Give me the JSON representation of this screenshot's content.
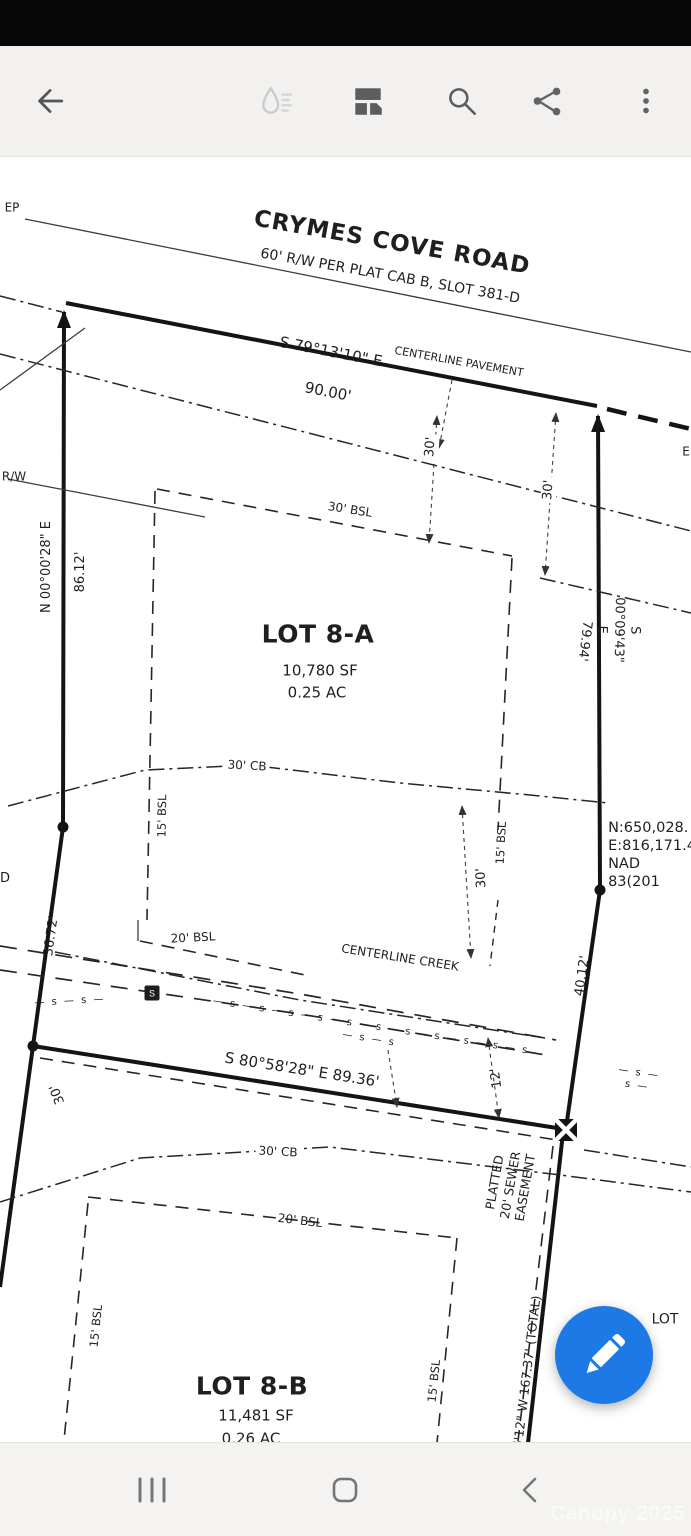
{
  "toolbar": {
    "icons": [
      "back-arrow",
      "ink-drop (disabled)",
      "collage",
      "search",
      "share",
      "overflow-menu"
    ]
  },
  "plat": {
    "labels": [
      {
        "id": "ep-label",
        "t": "EP",
        "x": 12,
        "y": 208,
        "r": 0,
        "s": 12
      },
      {
        "id": "rw-label",
        "t": "R/W",
        "x": 14,
        "y": 477,
        "r": 0,
        "s": 12
      },
      {
        "id": "d-label",
        "t": "D",
        "x": 5,
        "y": 879,
        "r": 0,
        "s": 13
      },
      {
        "id": "e-label",
        "t": "E",
        "x": 686,
        "y": 452,
        "r": 0,
        "s": 12
      },
      {
        "id": "road-name",
        "t": "CRYMES COVE ROAD",
        "x": 392,
        "y": 243,
        "r": 10,
        "s": 23,
        "w": 600,
        "ls": 1
      },
      {
        "id": "road-subtitle",
        "t": "60' R/W PER PLAT CAB B, SLOT 381-D",
        "x": 390,
        "y": 277,
        "r": 10,
        "s": 14
      },
      {
        "id": "bearing-road",
        "t": "S 79°13'10\" E",
        "x": 331,
        "y": 352,
        "r": 11,
        "s": 15
      },
      {
        "id": "distance-road",
        "t": "90.00'",
        "x": 328,
        "y": 392,
        "r": 11,
        "s": 15
      },
      {
        "id": "centerline-pavement",
        "t": "CENTERLINE PAVEMENT",
        "x": 459,
        "y": 362,
        "r": 10,
        "s": 11
      },
      {
        "id": "dim-30-left",
        "t": "30'",
        "x": 431,
        "y": 447,
        "r": -86,
        "s": 13,
        "bg": 1
      },
      {
        "id": "dim-30-right",
        "t": "30'",
        "x": 549,
        "y": 490,
        "r": -86,
        "s": 13,
        "bg": 1
      },
      {
        "id": "bsl-30",
        "t": "30' BSL",
        "x": 350,
        "y": 510,
        "r": 9,
        "s": 12
      },
      {
        "id": "bearing-west",
        "t": "N 00°00'28\" E",
        "x": 47,
        "y": 567,
        "r": -90,
        "s": 13
      },
      {
        "id": "distance-west",
        "t": "86.12'",
        "x": 81,
        "y": 572,
        "r": -90,
        "s": 13
      },
      {
        "id": "bearing-east",
        "t": "S 00°09'43\" E",
        "x": 618,
        "y": 630,
        "r": 91,
        "s": 13
      },
      {
        "id": "distance-east",
        "t": "79.94'",
        "x": 584,
        "y": 641,
        "r": 97,
        "s": 13
      },
      {
        "id": "lot8a-title",
        "t": "LOT 8-A",
        "x": 318,
        "y": 634,
        "r": 0,
        "s": 25,
        "w": 600,
        "ls": 0.5
      },
      {
        "id": "lot8a-area-sf",
        "t": "10,780 SF",
        "x": 320,
        "y": 671,
        "r": 0,
        "s": 15
      },
      {
        "id": "lot8a-area-ac",
        "t": "0.25 AC",
        "x": 317,
        "y": 693,
        "r": 0,
        "s": 15
      },
      {
        "id": "cb-30-upper",
        "t": "30' CB",
        "x": 247,
        "y": 766,
        "r": 3,
        "s": 12,
        "bg": 1
      },
      {
        "id": "bsl-15-left-8a",
        "t": "15' BSL",
        "x": 162,
        "y": 816,
        "r": -89,
        "s": 11.5
      },
      {
        "id": "bsl-15-right-8a",
        "t": "15' BSL",
        "x": 501,
        "y": 843,
        "r": -87,
        "s": 11.5
      },
      {
        "id": "dim-30-creek",
        "t": "30'",
        "x": 482,
        "y": 878,
        "r": -93,
        "s": 13,
        "bg": 1
      },
      {
        "id": "grid-coords",
        "t": "N:650,028.\nE:816,171.4\nNAD 83(201",
        "x": 652,
        "y": 855,
        "r": 0,
        "s": 14.5,
        "al": "left"
      },
      {
        "id": "distance-west-2",
        "t": "36.72'",
        "x": 52,
        "y": 936,
        "r": -82,
        "s": 13
      },
      {
        "id": "bsl-20-8a",
        "t": "20' BSL",
        "x": 193,
        "y": 938,
        "r": -3,
        "s": 12
      },
      {
        "id": "centerline-creek",
        "t": "CENTERLINE CREEK",
        "x": 400,
        "y": 958,
        "r": 9,
        "s": 12
      },
      {
        "id": "distance-east-2",
        "t": "40.12'",
        "x": 583,
        "y": 976,
        "r": -82,
        "s": 13
      },
      {
        "id": "bearing-south",
        "t": "S 80°58'28\" E  89.36'",
        "x": 302,
        "y": 1070,
        "r": 9,
        "s": 15
      },
      {
        "id": "dim-30-lower-left",
        "t": "30'",
        "x": 58,
        "y": 1094,
        "r": -112,
        "s": 13
      },
      {
        "id": "dim-12",
        "t": "12'",
        "x": 497,
        "y": 1078,
        "r": -98,
        "s": 13
      },
      {
        "id": "sewer-easement",
        "t": "PLATTED\n20' SEWER\nEASEMENT",
        "x": 510,
        "y": 1185,
        "r": -80,
        "s": 12.5
      },
      {
        "id": "cb-30-lower",
        "t": "30' CB",
        "x": 278,
        "y": 1152,
        "r": 3,
        "s": 12,
        "bg": 1
      },
      {
        "id": "lot-partial",
        "t": "LOT",
        "x": 665,
        "y": 1320,
        "r": 0,
        "s": 14
      },
      {
        "id": "bsl-20-8b",
        "t": "20' BSL",
        "x": 300,
        "y": 1221,
        "r": 7,
        "s": 12
      },
      {
        "id": "bsl-15-left-8b",
        "t": "15' BSL",
        "x": 96,
        "y": 1326,
        "r": -84,
        "s": 11.5
      },
      {
        "id": "bsl-15-right-8b",
        "t": "15' BSL",
        "x": 434,
        "y": 1381,
        "r": -84,
        "s": 11.5
      },
      {
        "id": "lot8b-title",
        "t": "LOT 8-B",
        "x": 252,
        "y": 1386,
        "r": 0,
        "s": 25,
        "w": 600,
        "ls": 0.5
      },
      {
        "id": "lot8b-area-sf",
        "t": "11,481 SF",
        "x": 256,
        "y": 1416,
        "r": 0,
        "s": 15
      },
      {
        "id": "lot8b-area-ac",
        "t": "0.26 AC",
        "x": 251,
        "y": 1439,
        "r": 0,
        "s": 15
      },
      {
        "id": "distance-total",
        "t": "6'12\" W  167.37' (TOTAL)",
        "x": 527,
        "y": 1372,
        "r": -83,
        "s": 12.5
      },
      {
        "id": "sewer-marks-1",
        "t": "— s — s —",
        "x": 70,
        "y": 1002,
        "r": -3,
        "s": 10,
        "ls": 2
      },
      {
        "id": "sewer-marks-2",
        "t": "— s — s — s — s — s — s — s — s — s — s — s — s — s",
        "x": 370,
        "y": 1033,
        "r": 9,
        "s": 10,
        "ls": 2
      },
      {
        "id": "sewer-marks-3",
        "t": "— s — s —",
        "x": 638,
        "y": 1080,
        "r": 9,
        "s": 10,
        "ls": 2
      }
    ],
    "lines": [
      {
        "id": "edge-of-pavement",
        "x1": 25,
        "y1": 219,
        "x2": 691,
        "y2": 352,
        "c": "thin"
      },
      {
        "id": "road-boundary",
        "x1": 66,
        "y1": 303,
        "x2": 597,
        "y2": 406,
        "c": "boundary"
      },
      {
        "id": "west-boundary-upper",
        "x1": 64,
        "y1": 312,
        "x2": 63,
        "y2": 827,
        "c": "boundary",
        "ms": "B"
      },
      {
        "id": "east-boundary-upper",
        "x1": 598,
        "y1": 416,
        "x2": 600,
        "y2": 890,
        "c": "boundary",
        "ms": "B"
      },
      {
        "id": "road-boundary-dash-right",
        "x1": 607,
        "y1": 409,
        "x2": 691,
        "y2": 429,
        "c": "heavydash"
      },
      {
        "id": "centerline-pavement-line",
        "x1": 0,
        "y1": 354,
        "x2": 691,
        "y2": 531,
        "c": "dashdot"
      },
      {
        "id": "rw-line-left",
        "x1": 8,
        "y1": 479,
        "x2": 205,
        "y2": 517,
        "c": "thin"
      },
      {
        "id": "rw-line-right",
        "x1": 540,
        "y1": 578,
        "x2": 691,
        "y2": 613,
        "c": "dashdot"
      },
      {
        "id": "west-boundary-mid",
        "x1": 63,
        "y1": 827,
        "x2": 33,
        "y2": 1046,
        "c": "boundary"
      },
      {
        "id": "west-boundary-lower",
        "x1": 33,
        "y1": 1046,
        "x2": 0,
        "y2": 1287,
        "c": "boundary"
      },
      {
        "id": "east-boundary-mid",
        "x1": 600,
        "y1": 890,
        "x2": 566,
        "y2": 1128,
        "c": "boundary"
      },
      {
        "id": "east-boundary-lower",
        "x1": 563,
        "y1": 1133,
        "x2": 528,
        "y2": 1443,
        "c": "boundary"
      },
      {
        "id": "south-boundary-8a",
        "x1": 33,
        "y1": 1046,
        "x2": 557,
        "y2": 1128,
        "c": "boundary"
      },
      {
        "id": "sewer-easement-north",
        "x1": 40,
        "y1": 1058,
        "x2": 557,
        "y2": 1140,
        "c": "dash"
      },
      {
        "id": "sewer-easement-east",
        "x1": 553,
        "y1": 1146,
        "x2": 518,
        "y2": 1441,
        "c": "dash"
      },
      {
        "id": "bsl-30-line",
        "x1": 157,
        "y1": 489,
        "x2": 512,
        "y2": 556,
        "c": "dash"
      },
      {
        "id": "bsl-left-8a-line",
        "x1": 155,
        "y1": 491,
        "x2": 147,
        "y2": 920,
        "c": "dash"
      },
      {
        "id": "bsl-right-8a-line",
        "x1": 512,
        "y1": 558,
        "x2": 498,
        "y2": 830,
        "c": "dash"
      },
      {
        "id": "dim-line-30-left",
        "x1": 437,
        "y1": 416,
        "x2": 429,
        "y2": 543,
        "c": "dim",
        "ms": "S",
        "me": "S"
      },
      {
        "id": "dim-line-30-right",
        "x1": 556,
        "y1": 413,
        "x2": 545,
        "y2": 575,
        "c": "dim",
        "ms": "S",
        "me": "S"
      },
      {
        "id": "dim-line-30-creek",
        "x1": 462,
        "y1": 806,
        "x2": 471,
        "y2": 958,
        "c": "dim",
        "ms": "S",
        "me": "S"
      },
      {
        "id": "dim-line-12",
        "x1": 488,
        "y1": 1038,
        "x2": 499,
        "y2": 1118,
        "c": "dim",
        "ms": "S",
        "me": "S"
      },
      {
        "id": "dim-leader-south",
        "x1": 388,
        "y1": 1050,
        "x2": 397,
        "y2": 1107,
        "c": "dim",
        "me": "S"
      },
      {
        "id": "pavement-leader",
        "x1": 452,
        "y1": 380,
        "x2": 439,
        "y2": 448,
        "c": "dim",
        "me": "S"
      },
      {
        "id": "bsl-20-8a-tick",
        "x1": 138,
        "y1": 920,
        "x2": 138,
        "y2": 941,
        "c": "thin"
      },
      {
        "id": "bsl-20-8a-line",
        "x1": 140,
        "y1": 941,
        "x2": 310,
        "y2": 976,
        "c": "dash"
      },
      {
        "id": "creek-right-tick",
        "x1": 498,
        "y1": 900,
        "x2": 490,
        "y2": 966,
        "c": "dashsm"
      },
      {
        "id": "bsl-20-8b-line",
        "x1": 88,
        "y1": 1197,
        "x2": 457,
        "y2": 1238,
        "c": "dash"
      },
      {
        "id": "bsl-left-8b-line",
        "x1": 88,
        "y1": 1203,
        "x2": 64,
        "y2": 1440,
        "c": "dash"
      },
      {
        "id": "bsl-right-8b-line",
        "x1": 457,
        "y1": 1238,
        "x2": 437,
        "y2": 1443,
        "c": "dash"
      },
      {
        "id": "dashdot-east-of-monument",
        "x1": 584,
        "y1": 1150,
        "x2": 691,
        "y2": 1167,
        "c": "dashdot"
      },
      {
        "id": "topleft-thin",
        "x1": 0,
        "y1": 390,
        "x2": 85,
        "y2": 328,
        "c": "thin"
      },
      {
        "id": "topleft-dashdot",
        "x1": 0,
        "y1": 296,
        "x2": 62,
        "y2": 312,
        "c": "dashdot"
      }
    ],
    "polylines": [
      {
        "id": "creek-buffer-30cb-upper",
        "pts": "8,806 145,770 250,765 400,783 530,795 608,803",
        "c": "dashdot"
      },
      {
        "id": "creek-line-1",
        "pts": "0,946 300,994 556,1040",
        "c": "creek"
      },
      {
        "id": "creek-line-2",
        "pts": "0,970 300,1014 552,1056",
        "c": "creek"
      },
      {
        "id": "creek-centerline",
        "pts": "55,952 300,1000 545,1038",
        "c": "dashdot"
      },
      {
        "id": "creek-buffer-30cb-lower",
        "pts": "0,1202 140,1158 330,1147 560,1175 691,1192",
        "c": "dashdot"
      }
    ],
    "points": [
      {
        "id": "monument-dot-west-1",
        "type": "dot",
        "x": 63,
        "y": 827
      },
      {
        "id": "monument-dot-west-2",
        "type": "dot",
        "x": 33,
        "y": 1046
      },
      {
        "id": "monument-dot-east",
        "type": "dot",
        "x": 600,
        "y": 890
      },
      {
        "id": "monument-crossed-square",
        "type": "crossed-square",
        "x": 566,
        "y": 1130
      },
      {
        "id": "sewer-manhole",
        "type": "sewer-box",
        "x": 152,
        "y": 993,
        "label": "S"
      }
    ]
  },
  "fab": {
    "icon": "pencil",
    "color": "#1d79e6"
  },
  "nav_bar": {
    "icons": [
      "recents",
      "home",
      "back"
    ]
  },
  "watermark": {
    "text": "Canopy 2025"
  }
}
